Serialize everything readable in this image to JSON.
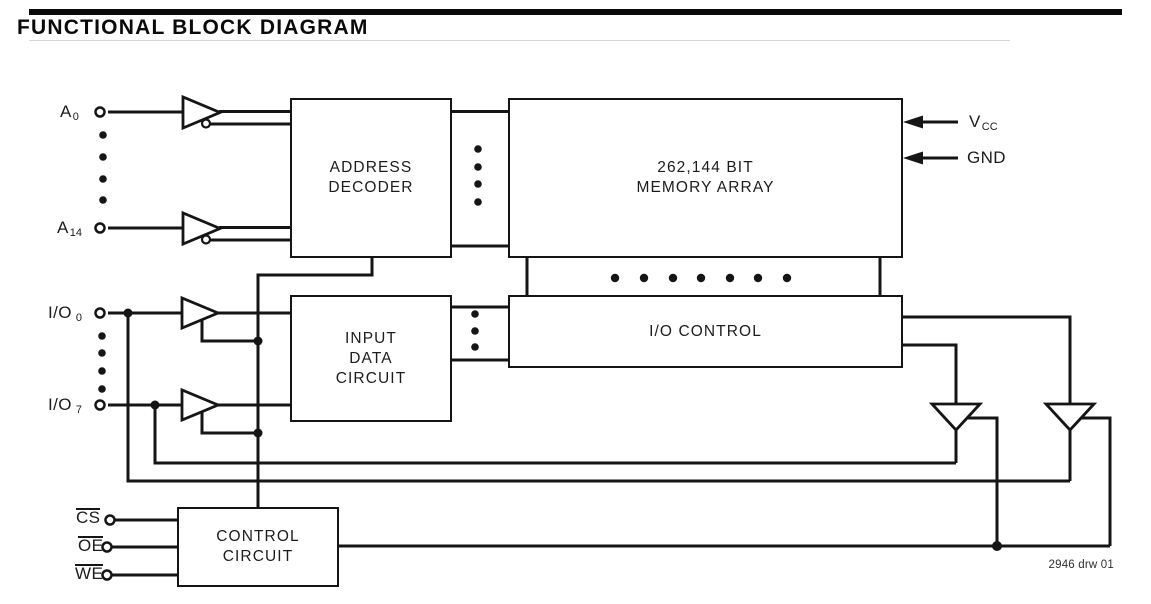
{
  "header": {
    "title": "FUNCTIONAL BLOCK DIAGRAM"
  },
  "blocks": {
    "address_decoder": {
      "line1": "ADDRESS",
      "line2": "DECODER"
    },
    "memory_array": {
      "line1": "262,144 BIT",
      "line2": "MEMORY ARRAY"
    },
    "input_data_circuit": {
      "line1": "INPUT",
      "line2": "DATA",
      "line3": "CIRCUIT"
    },
    "io_control": {
      "label": "I/O CONTROL"
    },
    "control_circuit": {
      "line1": "CONTROL",
      "line2": "CIRCUIT"
    }
  },
  "pins": {
    "a0": {
      "base": "A",
      "sub": "0"
    },
    "a14": {
      "base": "A",
      "sub": "14"
    },
    "io0": {
      "base": "I/O",
      "sub": "0"
    },
    "io7": {
      "base": "I/O",
      "sub": "7"
    },
    "vcc": {
      "base": "V",
      "sub": "CC"
    },
    "gnd": {
      "label": "GND"
    },
    "cs": {
      "label": "CS"
    },
    "oe": {
      "label": "OE"
    },
    "we": {
      "label": "WE"
    }
  },
  "annotations": {
    "drawing_number": "2946 drw 01"
  },
  "colors": {
    "line": "#151515",
    "background": "#ffffff",
    "title_bar": "#0a0a0a"
  }
}
